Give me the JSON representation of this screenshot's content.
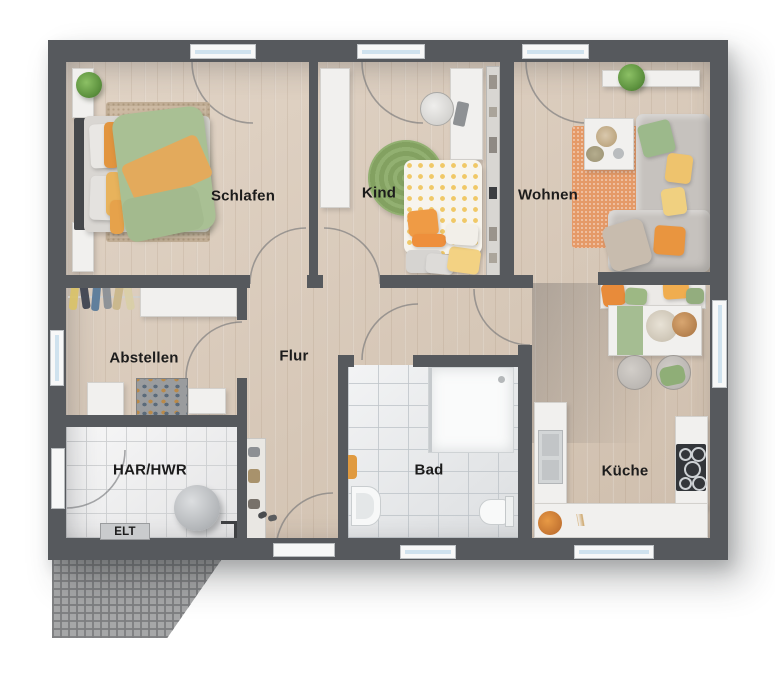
{
  "plan": {
    "type": "apartment-floor-plan-top-view",
    "language": "de",
    "rooms": {
      "schlafen": {
        "label": "Schlafen"
      },
      "kind": {
        "label": "Kind"
      },
      "wohnen": {
        "label": "Wohnen"
      },
      "abstellen": {
        "label": "Abstellen"
      },
      "flur": {
        "label": "Flur"
      },
      "har_hwr": {
        "label": "HAR/HWR"
      },
      "elt": {
        "label": "ELT"
      },
      "bad": {
        "label": "Bad"
      },
      "kueche": {
        "label": "Küche"
      }
    }
  },
  "colors": {
    "wall": "#56595d",
    "floor_wood": "#d9c8b6",
    "floor_tile_bad": "#e6e8ea",
    "floor_tile_hwr": "#ededee",
    "window_glass": "#cfe2ee",
    "accent_green": "#9cb98b",
    "accent_orange": "#e9953f",
    "accent_yellow": "#eec36d",
    "rug_wohnen": "#e59a68",
    "rug_kind": "#8fae6d",
    "terrace": "#a6a7a8"
  }
}
